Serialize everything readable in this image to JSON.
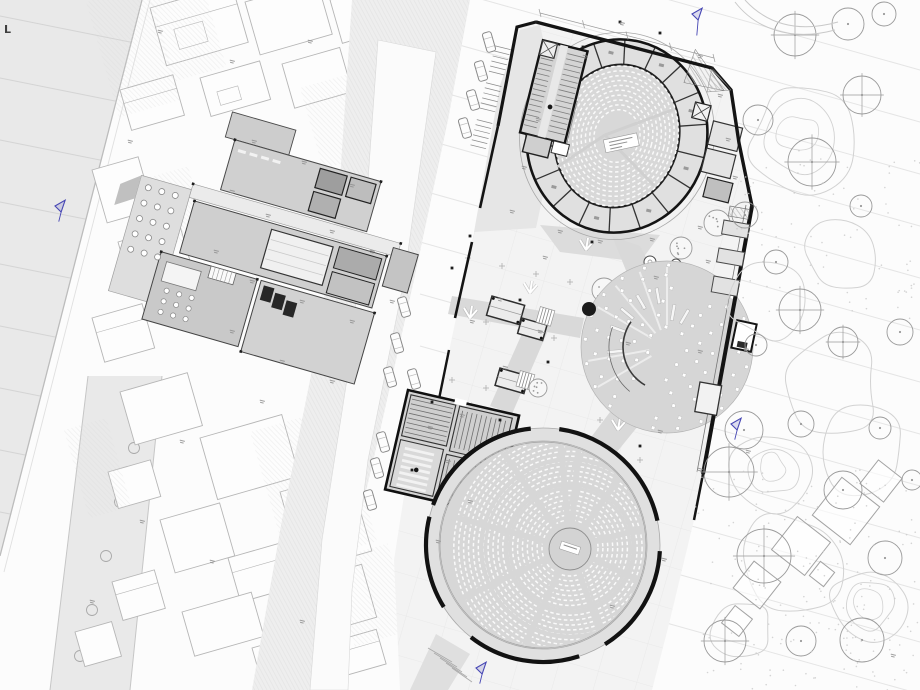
{
  "labels": {
    "corner": "L"
  },
  "colors": {
    "background": "#fcfcfc",
    "canal": "#e9e9e9",
    "canal_line": "#d4d4d4",
    "street": "#eeeeee",
    "road": "#fbfbfb",
    "fabric_stroke": "#b6b6b6",
    "building": "#d0d0d0",
    "wall": "#141414",
    "site": "#f3f3f3",
    "forecourt": "#e6e6e6",
    "path": "#d9d9d9",
    "bowl": "#d7d7d7",
    "ring": "#e0e0e0",
    "seat": "#fafafa",
    "grove": "#d6d6d6",
    "tree": "#9a9a9a",
    "contour": "#d2d2d2",
    "faint": "#e5e5e5",
    "blue": "#4646b4",
    "dot": "#1b1b1b",
    "micro": "#8f8f8f"
  },
  "benchmarks": [
    [
      55,
      206
    ],
    [
      692,
      14
    ],
    [
      731,
      424
    ],
    [
      476,
      668
    ]
  ],
  "black_dot": [
    589,
    309,
    7
  ],
  "cars": [
    [
      489,
      42
    ],
    [
      481,
      71
    ],
    [
      473,
      100
    ],
    [
      465,
      128
    ],
    [
      404,
      307
    ],
    [
      397,
      343
    ],
    [
      390,
      377
    ],
    [
      414,
      379
    ],
    [
      383,
      442
    ],
    [
      377,
      468
    ],
    [
      370,
      500
    ]
  ],
  "plaza_trees": [
    [
      717,
      223,
      13
    ],
    [
      681,
      248,
      11
    ],
    [
      604,
      290,
      12
    ],
    [
      538,
      388,
      9
    ],
    [
      463,
      447,
      8
    ],
    [
      497,
      453,
      9
    ]
  ],
  "twigs": [
    [
      530,
      293
    ],
    [
      470,
      318
    ],
    [
      468,
      414
    ],
    [
      503,
      432
    ],
    [
      586,
      250
    ],
    [
      618,
      430
    ]
  ],
  "right_trees": [
    [
      795,
      35,
      21,
      1
    ],
    [
      848,
      24,
      16,
      0
    ],
    [
      884,
      14,
      12,
      0
    ],
    [
      758,
      120,
      15,
      0
    ],
    [
      862,
      95,
      19,
      1
    ],
    [
      812,
      162,
      24,
      1
    ],
    [
      745,
      215,
      13,
      0
    ],
    [
      776,
      262,
      12,
      0
    ],
    [
      861,
      206,
      11,
      0
    ],
    [
      800,
      310,
      21,
      1
    ],
    [
      756,
      345,
      11,
      0
    ],
    [
      843,
      342,
      15,
      1
    ],
    [
      900,
      332,
      13,
      0
    ],
    [
      744,
      430,
      19,
      0
    ],
    [
      801,
      424,
      13,
      0
    ],
    [
      729,
      472,
      25,
      1
    ],
    [
      843,
      490,
      19,
      0
    ],
    [
      764,
      556,
      27,
      1
    ],
    [
      885,
      558,
      17,
      0
    ],
    [
      725,
      641,
      21,
      1
    ],
    [
      801,
      641,
      15,
      0
    ],
    [
      862,
      640,
      22,
      0
    ],
    [
      880,
      428,
      11,
      0
    ],
    [
      912,
      480,
      10,
      0
    ]
  ],
  "street_trees": [
    [
      146,
      398
    ],
    [
      134,
      448
    ],
    [
      120,
      502
    ],
    [
      106,
      556
    ],
    [
      92,
      610
    ],
    [
      80,
      656
    ]
  ],
  "fabric_blocks": [
    [
      150,
      8,
      85,
      60
    ],
    [
      245,
      2,
      75,
      55
    ],
    [
      330,
      0,
      55,
      45
    ],
    [
      120,
      90,
      55,
      42
    ],
    [
      200,
      78,
      62,
      40
    ],
    [
      282,
      64,
      60,
      46
    ],
    [
      352,
      44,
      48,
      78
    ],
    [
      92,
      170,
      48,
      55
    ],
    [
      118,
      242,
      64,
      50
    ],
    [
      92,
      318,
      52,
      46
    ],
    [
      120,
      392,
      70,
      55
    ],
    [
      200,
      438,
      85,
      64
    ],
    [
      280,
      492,
      72,
      82
    ],
    [
      160,
      520,
      62,
      55
    ],
    [
      108,
      472,
      44,
      38
    ],
    [
      228,
      558,
      56,
      46
    ],
    [
      300,
      582,
      64,
      55
    ],
    [
      182,
      612,
      72,
      46
    ],
    [
      112,
      582,
      44,
      40
    ],
    [
      75,
      632,
      38,
      36
    ],
    [
      252,
      648,
      56,
      36
    ],
    [
      332,
      642,
      46,
      36
    ],
    [
      372,
      120,
      40,
      60
    ],
    [
      398,
      560,
      40,
      46
    ],
    [
      420,
      620,
      40,
      40
    ]
  ],
  "hatch_patches": [
    [
      86,
      2,
      64,
      120
    ],
    [
      150,
      0,
      55,
      85
    ],
    [
      300,
      88,
      84,
      84
    ],
    [
      64,
      430,
      44,
      92
    ],
    [
      250,
      432,
      92,
      140
    ],
    [
      330,
      560,
      60,
      90
    ],
    [
      140,
      180,
      50,
      70
    ]
  ],
  "contours": [
    [
      800,
      135,
      55
    ],
    [
      768,
      300,
      38
    ],
    [
      828,
      385,
      52
    ],
    [
      772,
      470,
      40
    ],
    [
      862,
      452,
      46
    ],
    [
      792,
      562,
      55
    ],
    [
      868,
      604,
      38
    ],
    [
      742,
      628,
      32
    ],
    [
      838,
      258,
      36
    ]
  ],
  "diamonds": [
    [
      757,
      585,
      17
    ],
    [
      801,
      546,
      21
    ],
    [
      846,
      511,
      24
    ],
    [
      881,
      481,
      15
    ],
    [
      737,
      621,
      11
    ],
    [
      822,
      574,
      9
    ]
  ],
  "micro_labels": [
    [
      585,
      57
    ],
    [
      622,
      24
    ],
    [
      538,
      120
    ],
    [
      524,
      168
    ],
    [
      512,
      212
    ],
    [
      700,
      57
    ],
    [
      720,
      96
    ],
    [
      728,
      140
    ],
    [
      735,
      178
    ],
    [
      700,
      228
    ],
    [
      652,
      240
    ],
    [
      600,
      242
    ],
    [
      560,
      232
    ],
    [
      545,
      258
    ],
    [
      500,
      300
    ],
    [
      472,
      322
    ],
    [
      540,
      332
    ],
    [
      505,
      368
    ],
    [
      462,
      416
    ],
    [
      430,
      428
    ],
    [
      448,
      462
    ],
    [
      470,
      502
    ],
    [
      438,
      542
    ],
    [
      612,
      607
    ],
    [
      664,
      560
    ],
    [
      700,
      470
    ],
    [
      748,
      452
    ],
    [
      656,
      278
    ],
    [
      628,
      344
    ],
    [
      700,
      352
    ],
    [
      746,
      350
    ],
    [
      708,
      262
    ],
    [
      660,
      432
    ],
    [
      893,
      656
    ],
    [
      254,
      142
    ],
    [
      304,
      163
    ],
    [
      352,
      186
    ],
    [
      232,
      192
    ],
    [
      268,
      216
    ],
    [
      332,
      232
    ],
    [
      372,
      252
    ],
    [
      216,
      252
    ],
    [
      252,
      282
    ],
    [
      302,
      302
    ],
    [
      352,
      322
    ],
    [
      232,
      332
    ],
    [
      282,
      362
    ],
    [
      332,
      382
    ],
    [
      262,
      402
    ],
    [
      392,
      302
    ],
    [
      160,
      32
    ],
    [
      232,
      62
    ],
    [
      310,
      42
    ],
    [
      130,
      142
    ],
    [
      182,
      442
    ],
    [
      142,
      522
    ],
    [
      212,
      562
    ],
    [
      302,
      622
    ],
    [
      92,
      602
    ]
  ],
  "wall_dots": [
    [
      536,
      22
    ],
    [
      712,
      68
    ],
    [
      752,
      206
    ],
    [
      470,
      236
    ],
    [
      452,
      268
    ],
    [
      520,
      300
    ],
    [
      548,
      362
    ],
    [
      500,
      420
    ],
    [
      432,
      402
    ],
    [
      412,
      470
    ],
    [
      592,
      242
    ],
    [
      640,
      446
    ],
    [
      703,
      474
    ],
    [
      620,
      22
    ],
    [
      660,
      33
    ],
    [
      583,
      47
    ]
  ],
  "grid_crosses": [
    [
      468,
      258
    ],
    [
      502,
      266
    ],
    [
      536,
      274
    ],
    [
      570,
      282
    ],
    [
      486,
      322
    ],
    [
      520,
      330
    ],
    [
      554,
      338
    ],
    [
      452,
      380
    ],
    [
      486,
      388
    ],
    [
      600,
      420
    ],
    [
      640,
      460
    ],
    [
      700,
      300
    ],
    [
      720,
      230
    ],
    [
      604,
      290
    ]
  ],
  "grove": {
    "cx": 667,
    "cy": 347,
    "r": 86,
    "rings": [
      [
        20,
        7,
        10
      ],
      [
        33,
        11,
        26
      ],
      [
        46,
        14,
        8
      ],
      [
        59,
        17,
        20
      ],
      [
        72,
        19,
        4
      ],
      [
        82,
        21,
        14
      ]
    ],
    "benches": [
      [
        -100,
        52
      ],
      [
        -120,
        52
      ],
      [
        -140,
        52
      ],
      [
        -160,
        52
      ],
      [
        175,
        52
      ],
      [
        -80,
        35
      ],
      [
        -60,
        35
      ]
    ],
    "spokes": [
      -150,
      -130,
      -110,
      -90,
      150,
      170
    ]
  },
  "upper": {
    "cx": 617,
    "cy": 136,
    "rot": 14,
    "rows": 10
  },
  "lower": {
    "cx": 543,
    "cy": 545,
    "r_bowl": 103,
    "r_edge": 117,
    "rows": 19,
    "row_c": [
      570,
      548
    ],
    "aisles": [
      -95,
      -55,
      -15,
      25,
      70,
      115,
      155,
      195,
      235,
      275
    ],
    "arcs": [
      [
        -160,
        -96
      ],
      [
        -82,
        -12
      ],
      [
        3,
        58
      ],
      [
        72,
        128
      ],
      [
        148,
        194
      ],
      [
        208,
        256
      ]
    ]
  }
}
